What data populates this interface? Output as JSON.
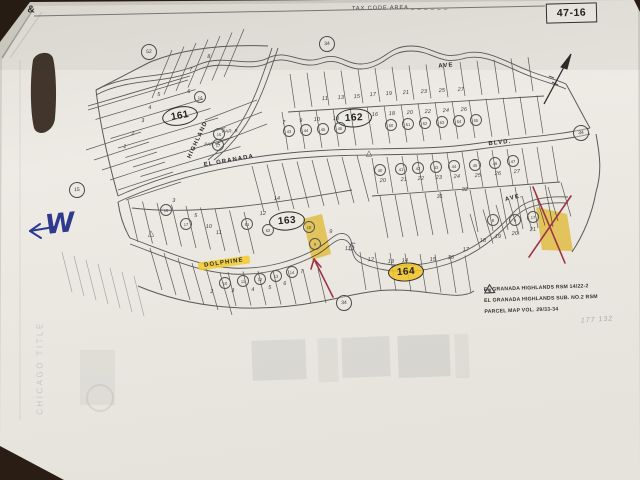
{
  "header": {
    "ampersand": "&",
    "tax_code_label": "TAX CODE AREA",
    "tax_code_dashes": "_ _ _ _ _ _",
    "page_number": "47-16"
  },
  "blocks": [
    {
      "id": "161",
      "x": 180,
      "y": 116,
      "rot": -10
    },
    {
      "id": "162",
      "x": 354,
      "y": 118,
      "rot": -3
    },
    {
      "id": "163",
      "x": 287,
      "y": 221,
      "rot": -5
    },
    {
      "id": "164",
      "x": 406,
      "y": 272,
      "rot": -4,
      "highlight": true
    }
  ],
  "streets": [
    {
      "name": "HIGHLAND",
      "x": 198,
      "y": 140,
      "rot": -65
    },
    {
      "name": "EL GRANADA",
      "x": 229,
      "y": 161,
      "rot": -10
    },
    {
      "name": "BLVD.",
      "x": 500,
      "y": 143,
      "rot": -6
    },
    {
      "name": "AVE",
      "x": 446,
      "y": 66,
      "rot": -5
    },
    {
      "name": "AVE.",
      "x": 514,
      "y": 198,
      "rot": -14
    },
    {
      "name": "DOLPHINE",
      "x": 224,
      "y": 263,
      "rot": -8,
      "highlight": true
    }
  ],
  "ref_circles": [
    {
      "n": "52",
      "x": 149,
      "y": 52
    },
    {
      "n": "34",
      "x": 327,
      "y": 44
    },
    {
      "n": "15",
      "x": 77,
      "y": 190
    },
    {
      "n": "34",
      "x": 581,
      "y": 133
    },
    {
      "n": "34",
      "x": 344,
      "y": 303
    }
  ],
  "parcel_circles": [
    {
      "n": "14",
      "x": 200,
      "y": 97
    },
    {
      "n": "16",
      "x": 219,
      "y": 134
    },
    {
      "n": "17",
      "x": 218,
      "y": 145
    },
    {
      "n": "43",
      "x": 289,
      "y": 131
    },
    {
      "n": "44",
      "x": 306,
      "y": 130
    },
    {
      "n": "45",
      "x": 323,
      "y": 129
    },
    {
      "n": "46",
      "x": 340,
      "y": 128
    },
    {
      "n": "60",
      "x": 391,
      "y": 125
    },
    {
      "n": "61",
      "x": 408,
      "y": 124
    },
    {
      "n": "62",
      "x": 425,
      "y": 123
    },
    {
      "n": "63",
      "x": 442,
      "y": 122
    },
    {
      "n": "64",
      "x": 459,
      "y": 121
    },
    {
      "n": "65",
      "x": 476,
      "y": 120
    },
    {
      "n": "40",
      "x": 380,
      "y": 170
    },
    {
      "n": "41",
      "x": 401,
      "y": 169
    },
    {
      "n": "42",
      "x": 418,
      "y": 168
    },
    {
      "n": "43",
      "x": 436,
      "y": 167
    },
    {
      "n": "44",
      "x": 454,
      "y": 166
    },
    {
      "n": "45",
      "x": 475,
      "y": 165
    },
    {
      "n": "46",
      "x": 495,
      "y": 163
    },
    {
      "n": "47",
      "x": 513,
      "y": 161
    },
    {
      "n": "16",
      "x": 166,
      "y": 210
    },
    {
      "n": "17",
      "x": 186,
      "y": 224
    },
    {
      "n": "61",
      "x": 247,
      "y": 224
    },
    {
      "n": "62",
      "x": 268,
      "y": 230
    },
    {
      "n": "10",
      "x": 225,
      "y": 283
    },
    {
      "n": "11",
      "x": 243,
      "y": 281
    },
    {
      "n": "12",
      "x": 260,
      "y": 279
    },
    {
      "n": "13",
      "x": 276,
      "y": 276
    },
    {
      "n": "14",
      "x": 292,
      "y": 272
    },
    {
      "n": "8",
      "x": 493,
      "y": 220
    },
    {
      "n": "9",
      "x": 515,
      "y": 220
    },
    {
      "n": "17",
      "x": 533,
      "y": 217
    },
    {
      "n": "10",
      "x": 309,
      "y": 227
    },
    {
      "n": "9",
      "x": 315,
      "y": 244
    }
  ],
  "lot_numbers": [
    {
      "n": "8",
      "x": 209,
      "y": 57
    },
    {
      "n": "7",
      "x": 191,
      "y": 70
    },
    {
      "n": "6",
      "x": 189,
      "y": 92
    },
    {
      "n": "5",
      "x": 159,
      "y": 95
    },
    {
      "n": "4",
      "x": 150,
      "y": 108
    },
    {
      "n": "3",
      "x": 143,
      "y": 121
    },
    {
      "n": "2",
      "x": 133,
      "y": 134
    },
    {
      "n": "1",
      "x": 125,
      "y": 147
    },
    {
      "n": "PAR. B",
      "x": 230,
      "y": 131,
      "s": 4.5
    },
    {
      "n": "PAR. A",
      "x": 212,
      "y": 144,
      "s": 4.5
    },
    {
      "n": "11",
      "x": 325,
      "y": 99
    },
    {
      "n": "13",
      "x": 341,
      "y": 98
    },
    {
      "n": "15",
      "x": 357,
      "y": 97
    },
    {
      "n": "17",
      "x": 373,
      "y": 95
    },
    {
      "n": "19",
      "x": 389,
      "y": 94
    },
    {
      "n": "21",
      "x": 406,
      "y": 93
    },
    {
      "n": "23",
      "x": 424,
      "y": 92
    },
    {
      "n": "25",
      "x": 442,
      "y": 91
    },
    {
      "n": "27",
      "x": 461,
      "y": 90
    },
    {
      "n": "7",
      "x": 284,
      "y": 123
    },
    {
      "n": "9",
      "x": 301,
      "y": 121
    },
    {
      "n": "10",
      "x": 317,
      "y": 120
    },
    {
      "n": "13",
      "x": 336,
      "y": 119
    },
    {
      "n": "16",
      "x": 375,
      "y": 115
    },
    {
      "n": "18",
      "x": 392,
      "y": 114
    },
    {
      "n": "20",
      "x": 410,
      "y": 113
    },
    {
      "n": "22",
      "x": 428,
      "y": 112
    },
    {
      "n": "24",
      "x": 446,
      "y": 111
    },
    {
      "n": "26",
      "x": 464,
      "y": 110
    },
    {
      "n": "20",
      "x": 383,
      "y": 181
    },
    {
      "n": "21",
      "x": 404,
      "y": 180
    },
    {
      "n": "22",
      "x": 421,
      "y": 179
    },
    {
      "n": "23",
      "x": 439,
      "y": 178
    },
    {
      "n": "24",
      "x": 457,
      "y": 177
    },
    {
      "n": "25",
      "x": 478,
      "y": 176
    },
    {
      "n": "26",
      "x": 498,
      "y": 174
    },
    {
      "n": "27",
      "x": 517,
      "y": 172
    },
    {
      "n": "31",
      "x": 440,
      "y": 197
    },
    {
      "n": "32",
      "x": 465,
      "y": 190
    },
    {
      "n": "3",
      "x": 174,
      "y": 201
    },
    {
      "n": "5",
      "x": 196,
      "y": 216
    },
    {
      "n": "10",
      "x": 209,
      "y": 227
    },
    {
      "n": "11",
      "x": 219,
      "y": 233
    },
    {
      "n": "12",
      "x": 263,
      "y": 214
    },
    {
      "n": "14",
      "x": 277,
      "y": 199
    },
    {
      "n": "2",
      "x": 212,
      "y": 292
    },
    {
      "n": "3",
      "x": 233,
      "y": 291
    },
    {
      "n": "4",
      "x": 253,
      "y": 290
    },
    {
      "n": "5",
      "x": 270,
      "y": 288
    },
    {
      "n": "6",
      "x": 285,
      "y": 284
    },
    {
      "n": "7",
      "x": 302,
      "y": 272
    },
    {
      "n": "9",
      "x": 331,
      "y": 232
    },
    {
      "n": "11",
      "x": 348,
      "y": 249
    },
    {
      "n": "12",
      "x": 371,
      "y": 260
    },
    {
      "n": "13",
      "x": 391,
      "y": 262
    },
    {
      "n": "14",
      "x": 405,
      "y": 261
    },
    {
      "n": "15",
      "x": 433,
      "y": 260
    },
    {
      "n": "16",
      "x": 451,
      "y": 258
    },
    {
      "n": "17",
      "x": 466,
      "y": 250
    },
    {
      "n": "18",
      "x": 483,
      "y": 241
    },
    {
      "n": "19",
      "x": 498,
      "y": 237
    },
    {
      "n": "20",
      "x": 515,
      "y": 234
    },
    {
      "n": "21",
      "x": 533,
      "y": 230
    }
  ],
  "triangle_markers": [
    {
      "x": 151,
      "y": 233
    },
    {
      "x": 369,
      "y": 153
    }
  ],
  "legend": {
    "items": [
      {
        "marker": "1",
        "text": "EL GRANADA HIGHLANDS RSM 14/22-2"
      },
      {
        "marker": "2",
        "text": "EL GRANADA HIGHLANDS SUB. NO.2 RSM"
      },
      {
        "marker": "3",
        "text": "PARCEL MAP VOL. 29/33-34"
      }
    ]
  },
  "annotations": {
    "west_note": "W",
    "pencil_note": "177 132",
    "hand_five": "5",
    "ghost_text": "CHICAGO TITLE"
  },
  "colors": {
    "desk": "#2c2016",
    "paper": "#e9e7e0",
    "highlight": "#f3c426",
    "red_ink": "#9c3448",
    "blue_ink": "#2f3a8f"
  },
  "map_geometry": {
    "combs": [
      {
        "x": 88,
        "y": 110,
        "sx": 7.5,
        "sy": 9.5,
        "dx": 100,
        "dy": -30,
        "n": 8
      },
      {
        "x": 152,
        "y": 98,
        "sx": 12,
        "sy": -3.5,
        "dx": 20,
        "dy": -48,
        "n": 7
      },
      {
        "x": 290,
        "y": 74,
        "sx": 17,
        "sy": -1.2,
        "dx": 5,
        "dy": 34,
        "n": 15
      },
      {
        "x": 282,
        "y": 112,
        "sx": 17,
        "sy": -1.1,
        "dx": 6,
        "dy": 38,
        "n": 16
      },
      {
        "x": 128,
        "y": 200,
        "sx": 14.5,
        "sy": 1.5,
        "dx": 10,
        "dy": 42,
        "n": 9
      },
      {
        "x": 252,
        "y": 166,
        "sx": 15,
        "sy": -1.5,
        "dx": 12,
        "dy": 46,
        "n": 8
      },
      {
        "x": 372,
        "y": 158,
        "sx": 15,
        "sy": -1,
        "dx": 6,
        "dy": 36,
        "n": 13
      },
      {
        "x": 380,
        "y": 196,
        "sx": 15,
        "sy": -1,
        "dx": 8,
        "dy": 42,
        "n": 12
      },
      {
        "x": 150,
        "y": 248,
        "sx": 14,
        "sy": 5,
        "dx": 12,
        "dy": 42,
        "n": 6
      },
      {
        "x": 228,
        "y": 272,
        "sx": 15,
        "sy": -0.5,
        "dx": 8,
        "dy": 34,
        "n": 7
      },
      {
        "x": 360,
        "y": 252,
        "sx": 15,
        "sy": 0.5,
        "dx": 6,
        "dy": 38,
        "n": 8
      },
      {
        "x": 470,
        "y": 214,
        "sx": 13,
        "sy": -4.5,
        "dx": 10,
        "dy": 34,
        "n": 8
      },
      {
        "x": 62,
        "y": 252,
        "sx": 12,
        "sy": 4,
        "dx": 10,
        "dy": 40,
        "n": 7,
        "o": 0.45
      },
      {
        "x": 86,
        "y": 150,
        "sx": 8,
        "sy": 10,
        "dx": 55,
        "dy": -18,
        "n": 6
      },
      {
        "x": 205,
        "y": 120,
        "sx": 5,
        "sy": 12,
        "dx": 52,
        "dy": -20,
        "n": 3
      }
    ]
  }
}
